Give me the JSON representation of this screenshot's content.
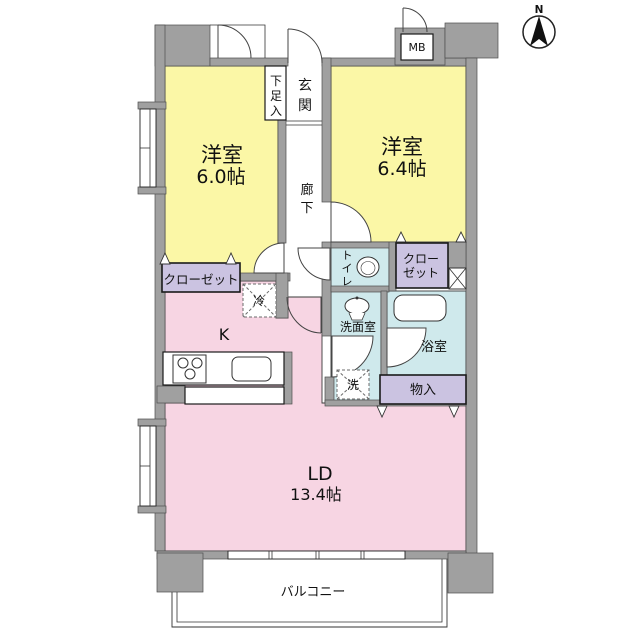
{
  "title": "1LDK apartment floor plan",
  "labels": {
    "bedroom1_name": "洋室",
    "bedroom1_size": "6.0帖",
    "bedroom2_name": "洋室",
    "bedroom2_size": "6.4帖",
    "living_name": "LD",
    "living_size": "13.4帖",
    "kitchen": "K",
    "entrance": "玄関",
    "hallway": "廊下",
    "shoe_cupboard": "下足入",
    "closet_left": "クローゼット",
    "closet_right_line1": "クロー",
    "closet_right_line2": "ゼット",
    "toilet": "トイレ",
    "washroom": "洗面室",
    "bathroom": "浴室",
    "storage": "物入",
    "washer": "洗",
    "fridge": "冷",
    "meter_box": "MB",
    "balcony": "バルコニー",
    "north": "N"
  },
  "colors": {
    "wall": "#a0a0a0",
    "bedroom_fill": "#fbf7a6",
    "living_fill": "#f7d5e3",
    "wet_area_fill": "#cfe9ec",
    "closet_fill": "#cbc3e1",
    "outline": "#333333",
    "background": "#ffffff"
  }
}
